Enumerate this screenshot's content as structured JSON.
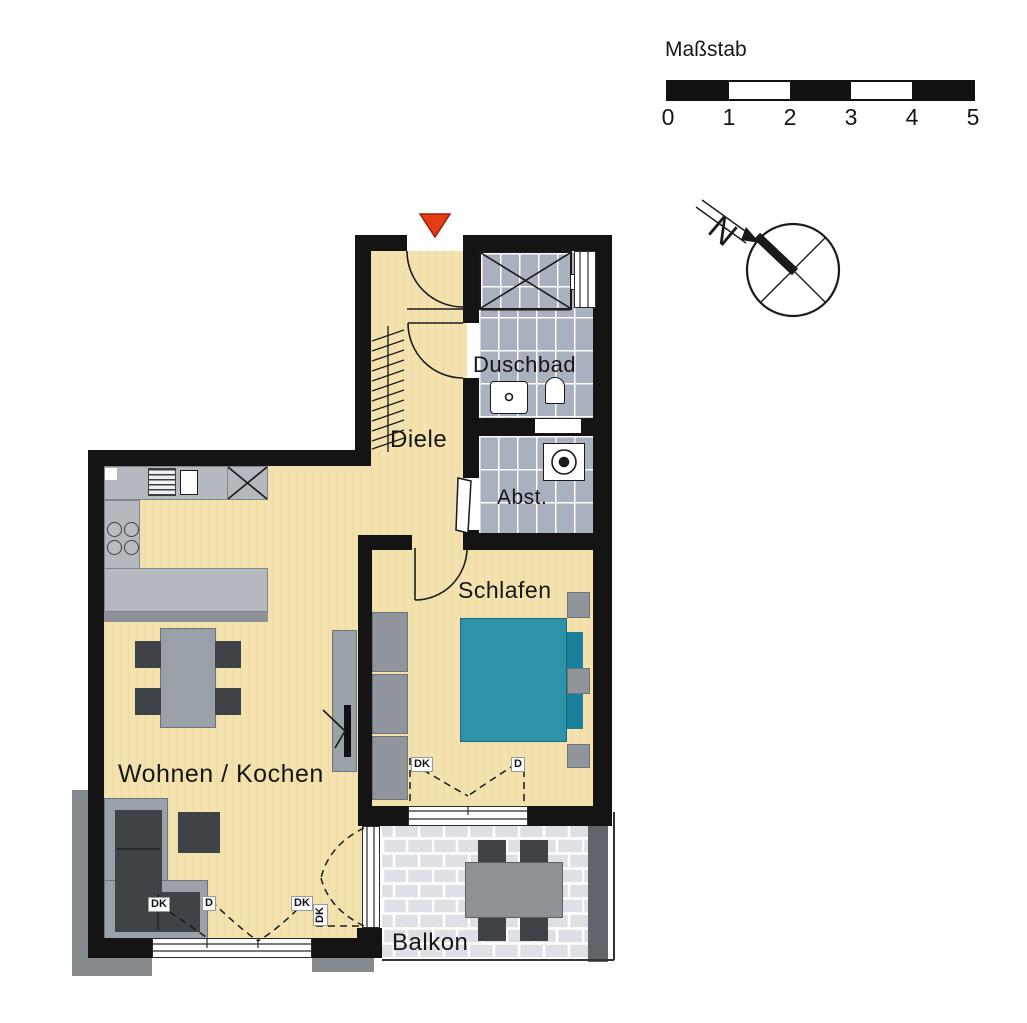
{
  "scale_bar": {
    "title": "Maßstab",
    "ticks": [
      "0",
      "1",
      "2",
      "3",
      "4",
      "5"
    ]
  },
  "compass": {
    "north_label": "N"
  },
  "rooms": {
    "duschbad": "Duschbad",
    "diele": "Diele",
    "abst": "Abst.",
    "schlafen": "Schlafen",
    "wohnen_kochen": "Wohnen / Kochen",
    "balkon": "Balkon"
  },
  "window_labels": {
    "living_left": "DK",
    "living_mid": "D",
    "living_right": "DK",
    "balcony_door": "DK",
    "bedroom_left": "DK",
    "bedroom_right": "D"
  },
  "colors": {
    "wall": "#141414",
    "floor_cream": "#f4e2ae",
    "tile_gray": "#a9b1bf",
    "paver_gray": "#dde1e6",
    "furniture_gray": "#9ba1a8",
    "counter_gray": "#b4b8bf",
    "dark_gray": "#3f4347",
    "bed_teal": "#2e93aa",
    "pillow_teal": "#1a7f9b",
    "wardrobe_gray": "#8f959b",
    "exterior_gray": "#84898e",
    "balcony_wall_gray": "#5f656b",
    "entrance_marker_red": "#e43c17"
  }
}
